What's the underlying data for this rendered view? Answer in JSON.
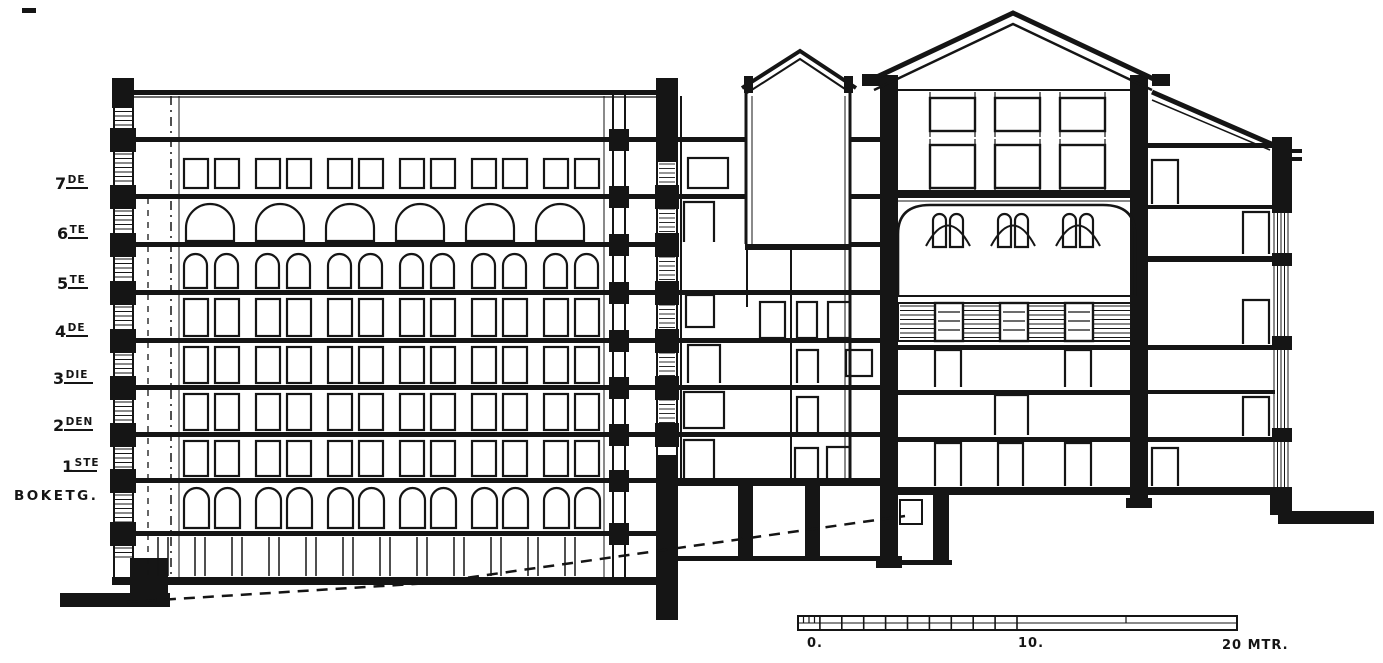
{
  "colors": {
    "ink": "#151515",
    "paper": "#ffffff"
  },
  "floor_labels": [
    {
      "id": "7de",
      "number": "7",
      "suffix": "DE",
      "word": ""
    },
    {
      "id": "6te",
      "number": "6",
      "suffix": "TE",
      "word": ""
    },
    {
      "id": "5te",
      "number": "5",
      "suffix": "TE",
      "word": ""
    },
    {
      "id": "4de",
      "number": "4",
      "suffix": "DE",
      "word": ""
    },
    {
      "id": "3die",
      "number": "3",
      "suffix": "DIE",
      "word": ""
    },
    {
      "id": "2den",
      "number": "2",
      "suffix": "DEN",
      "word": ""
    },
    {
      "id": "1ste",
      "number": "1",
      "suffix": "STE",
      "word": ""
    },
    {
      "id": "boketg",
      "number": "",
      "suffix": "",
      "word": "BOKETG."
    }
  ],
  "scale_bar": {
    "label_0": "0.",
    "label_10": "10.",
    "label_20": "20 MTR.",
    "unit": "MTR",
    "range_meters": [
      0,
      20
    ]
  }
}
